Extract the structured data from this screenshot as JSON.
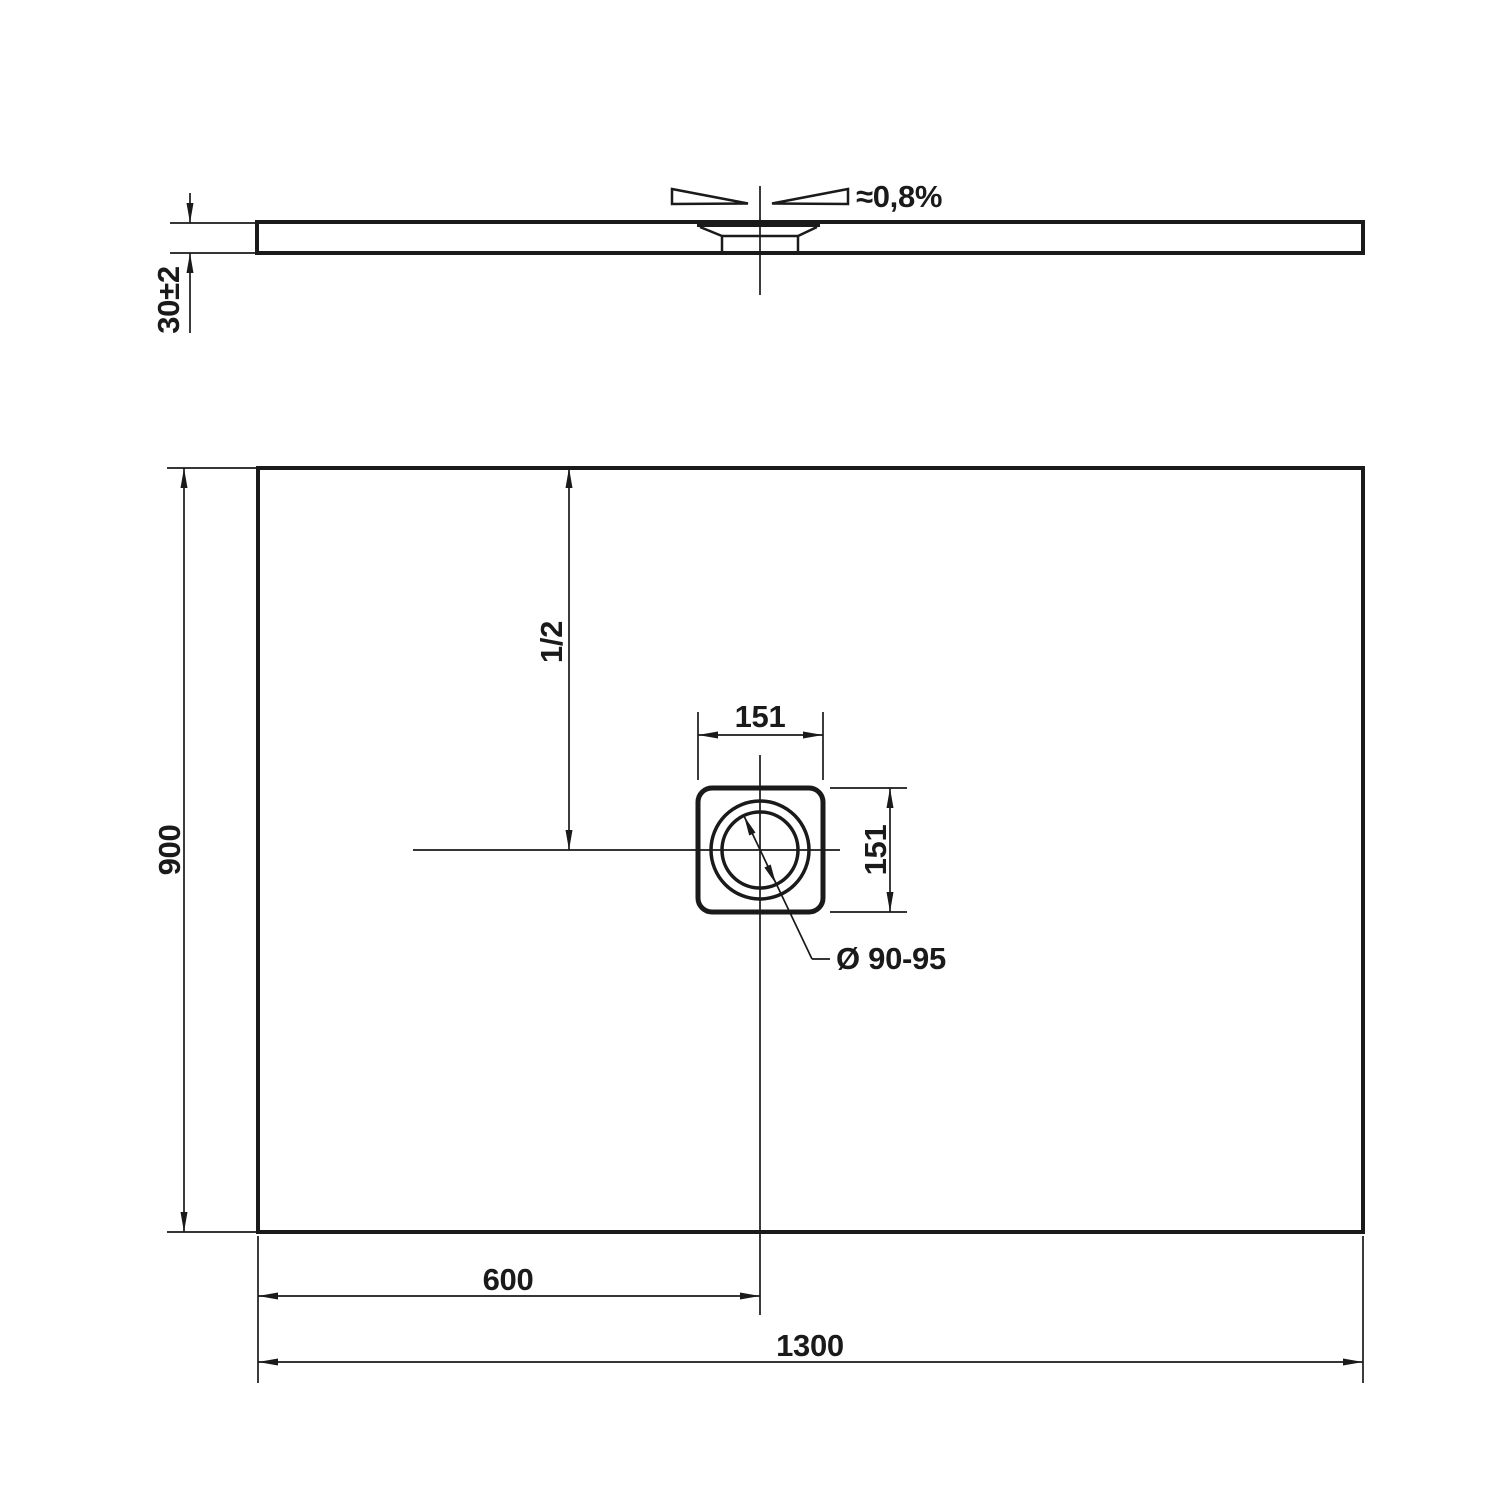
{
  "colors": {
    "line": "#1a1a1a",
    "background": "#ffffff"
  },
  "side_view": {
    "thickness_label": "30±2",
    "slope_label": "≈0,8%"
  },
  "plan_view": {
    "height_label": "900",
    "half_height_label": "1/2",
    "drain_square_width_label": "151",
    "drain_square_height_label": "151",
    "drain_diameter_label": "Ø 90-95",
    "drain_offset_label": "600",
    "width_label": "1300"
  }
}
